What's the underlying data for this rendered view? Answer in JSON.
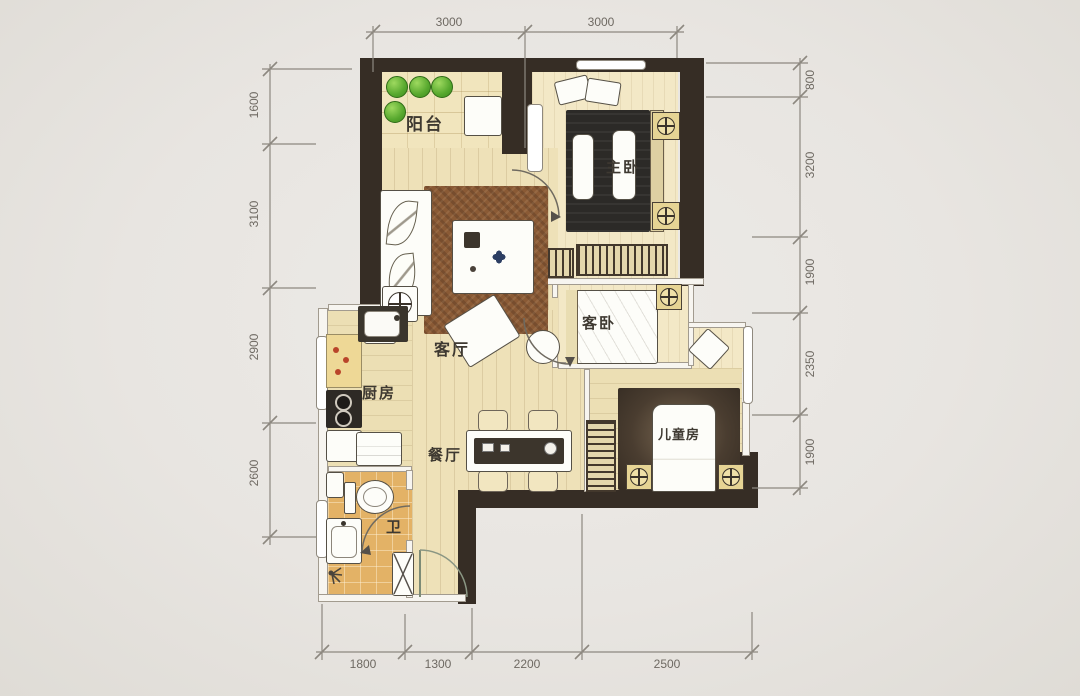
{
  "plan_title": "two-bed-plus-children-room-apartment-floor-plan",
  "rooms": {
    "balcony": "阳台",
    "master": "主卧",
    "living": "客厅",
    "guest": "客卧",
    "children": "儿童房",
    "kitchen": "厨房",
    "dining": "餐厅",
    "bath": "卫"
  },
  "dims": {
    "top": [
      "3000",
      "3000"
    ],
    "left": [
      "1600",
      "3100",
      "2900",
      "2600"
    ],
    "right": [
      "800",
      "3200",
      "1900",
      "2350",
      "1900"
    ],
    "bottom": [
      "1800",
      "1300",
      "2200",
      "2500"
    ]
  },
  "colors": {
    "background": "#e9e6e2",
    "wall": "#362d25",
    "floor_wood": "#eee1b8",
    "floor_cream": "#f3e8c6",
    "balcony_floor": "#f1e5bd",
    "bath_tile": "#e3b266",
    "rug": "#8a5a35",
    "plant_green": "#5fb835",
    "dim_line": "#8d8880"
  }
}
